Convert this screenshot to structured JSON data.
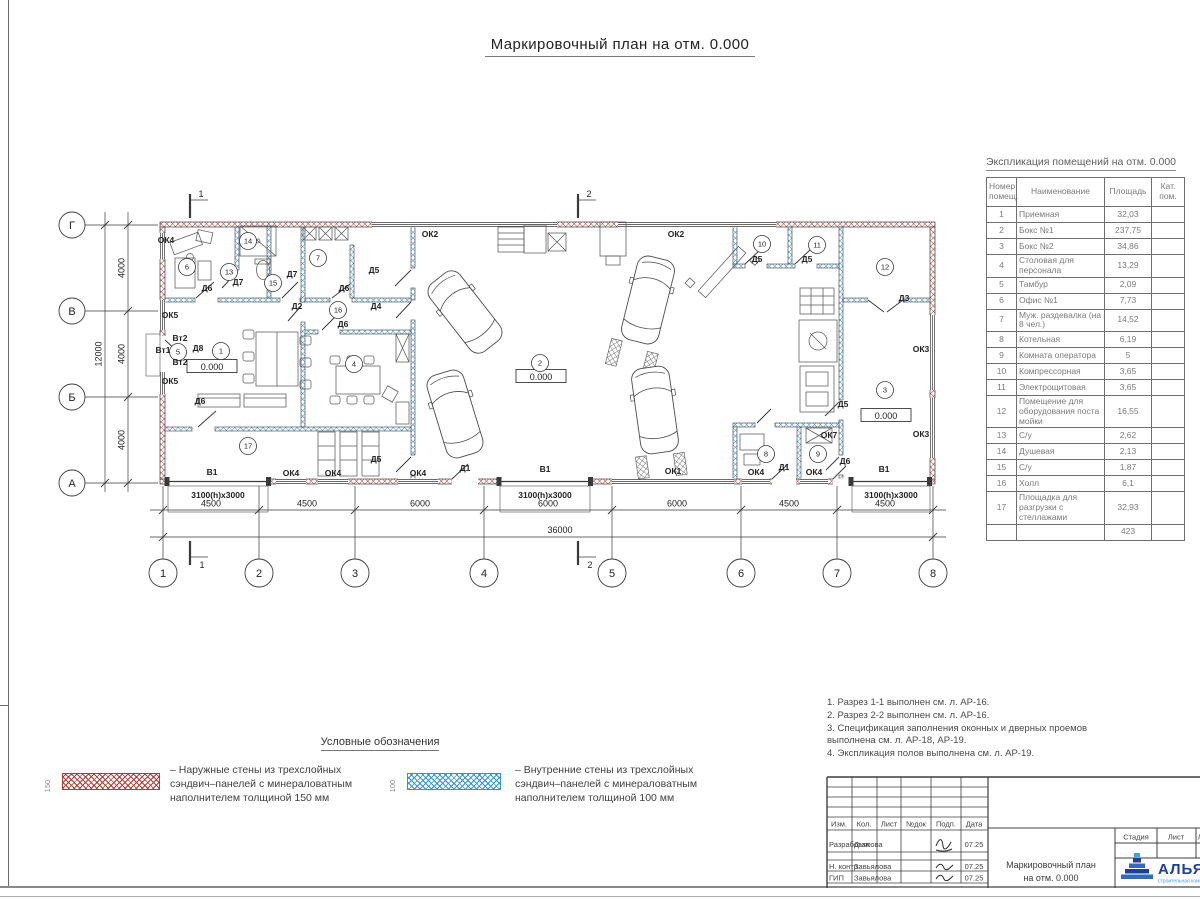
{
  "title": "Маркировочный план на отм. 0.000",
  "colors": {
    "exterior_hatch": "#b23a33",
    "interior_hatch": "#2f93cf",
    "logo_navy": "#1d3f97",
    "logo_blue": "#44a1d9"
  },
  "spec_table": {
    "title": "Экспликация помещений на отм. 0.000",
    "headers": {
      "num": "Номер помещ.",
      "name": "Наименование",
      "area": "Площадь",
      "cat": "Кат. пом."
    },
    "rows": [
      {
        "n": "1",
        "name": "Приемная",
        "area": "32,03"
      },
      {
        "n": "2",
        "name": "Бокс №1",
        "area": "237,75"
      },
      {
        "n": "3",
        "name": "Бокс №2",
        "area": "34,86"
      },
      {
        "n": "4",
        "name": "Столовая для персонала",
        "area": "13,29"
      },
      {
        "n": "5",
        "name": "Тамбур",
        "area": "2,09"
      },
      {
        "n": "6",
        "name": "Офис №1",
        "area": "7,73"
      },
      {
        "n": "7",
        "name": "Муж. раздевалка (на 8 чел.)",
        "area": "14,52"
      },
      {
        "n": "8",
        "name": "Котельная",
        "area": "6,19"
      },
      {
        "n": "9",
        "name": "Комната оператора",
        "area": "5"
      },
      {
        "n": "10",
        "name": "Компрессорная",
        "area": "3,65"
      },
      {
        "n": "11",
        "name": "Электрощитовая",
        "area": "3,65"
      },
      {
        "n": "12",
        "name": "Помещение для оборудования поста мойки",
        "area": "16,55"
      },
      {
        "n": "13",
        "name": "С/у",
        "area": "2,62"
      },
      {
        "n": "14",
        "name": "Душевая",
        "area": "2,13"
      },
      {
        "n": "15",
        "name": "С/у",
        "area": "1,87"
      },
      {
        "n": "16",
        "name": "Холл",
        "area": "6,1"
      },
      {
        "n": "17",
        "name": "Площадка для разгрузки с стеллажами",
        "area": "32,93"
      }
    ],
    "total": "423"
  },
  "notes": [
    "1. Разрез 1-1 выполнен см. л. АР-16.",
    "2. Разрез 2-2 выполнен см. л. АР-16.",
    "3. Спецификация заполнения оконных и дверных проемов выполнена см. л. АР-18, АР-19.",
    "4. Экспликация полов выполнена см. л. АР-19."
  ],
  "legend": {
    "title": "Условные обозначения",
    "items": [
      {
        "dim": "150",
        "color": "#b23a33",
        "text": "– Наружные стены из трехслойных сэндвич–панелей с минераловатным наполнителем толщиной 150 мм"
      },
      {
        "dim": "100",
        "color": "#2f93cf",
        "text": "– Внутренние стены из трехслойных сэндвич–панелей с минераловатным наполнителем толщиной 100 мм"
      }
    ]
  },
  "title_block": {
    "cols": [
      "Изм.",
      "Кол.",
      "Лист",
      "№док",
      "Подп.",
      "Дата"
    ],
    "rows": [
      {
        "role": "Разработал",
        "name": "Дьякова",
        "date": "07.25"
      },
      {
        "role": "Н. контр.",
        "name": "Завьялова",
        "date": "07.25"
      },
      {
        "role": "ГИП",
        "name": "Завьялова",
        "date": "07.25"
      }
    ],
    "doc_title_line1": "Маркировочный план",
    "doc_title_line2": "на отм. 0.000",
    "stage_cols": [
      "Стадия",
      "Лист",
      "Лис"
    ],
    "logo_text": "АЛЬЯН",
    "logo_sub": "строительная комп"
  },
  "plan": {
    "elev_value": "0.000",
    "axes_v": [
      {
        "n": "1",
        "x": 163
      },
      {
        "n": "2",
        "x": 259
      },
      {
        "n": "3",
        "x": 355
      },
      {
        "n": "4",
        "x": 484
      },
      {
        "n": "5",
        "x": 612
      },
      {
        "n": "6",
        "x": 741
      },
      {
        "n": "7",
        "x": 837
      },
      {
        "n": "8",
        "x": 933
      }
    ],
    "axes_h": [
      {
        "n": "Г",
        "y": 225
      },
      {
        "n": "В",
        "y": 311
      },
      {
        "n": "Б",
        "y": 397
      },
      {
        "n": "А",
        "y": 483
      }
    ],
    "dims_bottom": [
      {
        "t": "4500",
        "x": 211
      },
      {
        "t": "4500",
        "x": 307
      },
      {
        "t": "6000",
        "x": 420
      },
      {
        "t": "6000",
        "x": 548
      },
      {
        "t": "6000",
        "x": 677
      },
      {
        "t": "4500",
        "x": 789
      },
      {
        "t": "4500",
        "x": 885
      }
    ],
    "dim_total": {
      "t": "36000",
      "x": 560
    },
    "dims_left": [
      {
        "t": "4000",
        "y": 268
      },
      {
        "t": "4000",
        "y": 354
      },
      {
        "t": "4000",
        "y": 440
      }
    ],
    "dim_left_total": {
      "t": "12000",
      "y": 354
    },
    "sections": [
      {
        "t": "1",
        "x": 190
      },
      {
        "t": "2",
        "x": 578
      }
    ],
    "elev": [
      {
        "x": 212,
        "y": 367
      },
      {
        "x": 541,
        "y": 377
      },
      {
        "x": 886,
        "y": 416
      }
    ],
    "rooms": [
      {
        "n": "1",
        "x": 221,
        "y": 351
      },
      {
        "n": "2",
        "x": 540,
        "y": 363
      },
      {
        "n": "3",
        "x": 885,
        "y": 390
      },
      {
        "n": "4",
        "x": 354,
        "y": 364
      },
      {
        "n": "5",
        "x": 178,
        "y": 352
      },
      {
        "n": "6",
        "x": 187,
        "y": 267
      },
      {
        "n": "7",
        "x": 318,
        "y": 258
      },
      {
        "n": "8",
        "x": 766,
        "y": 454
      },
      {
        "n": "9",
        "x": 818,
        "y": 454
      },
      {
        "n": "10",
        "x": 762,
        "y": 244
      },
      {
        "n": "11",
        "x": 817,
        "y": 245
      },
      {
        "n": "12",
        "x": 885,
        "y": 267
      },
      {
        "n": "13",
        "x": 229,
        "y": 272
      },
      {
        "n": "14",
        "x": 248,
        "y": 241
      },
      {
        "n": "15",
        "x": 273,
        "y": 283
      },
      {
        "n": "16",
        "x": 338,
        "y": 310
      },
      {
        "n": "17",
        "x": 248,
        "y": 446
      }
    ],
    "labels": [
      {
        "t": "ОК4",
        "x": 166,
        "y": 243
      },
      {
        "t": "ОК5",
        "x": 170,
        "y": 318
      },
      {
        "t": "Вт2",
        "x": 180,
        "y": 341
      },
      {
        "t": "Вт1",
        "x": 163,
        "y": 353
      },
      {
        "t": "Вт2",
        "x": 180,
        "y": 365
      },
      {
        "t": "Д8",
        "x": 198,
        "y": 351
      },
      {
        "t": "ОК5",
        "x": 170,
        "y": 384
      },
      {
        "t": "Д6",
        "x": 207,
        "y": 291
      },
      {
        "t": "Д7",
        "x": 238,
        "y": 285
      },
      {
        "t": "Д7",
        "x": 292,
        "y": 277
      },
      {
        "t": "Д5",
        "x": 374,
        "y": 273
      },
      {
        "t": "Д6",
        "x": 344,
        "y": 291
      },
      {
        "t": "Д2",
        "x": 297,
        "y": 309
      },
      {
        "t": "Д4",
        "x": 376,
        "y": 309
      },
      {
        "t": "Д6",
        "x": 343,
        "y": 327
      },
      {
        "t": "Д6",
        "x": 200,
        "y": 404
      },
      {
        "t": "Д5",
        "x": 376,
        "y": 462
      },
      {
        "t": "ОК2",
        "x": 430,
        "y": 237
      },
      {
        "t": "ОК2",
        "x": 676,
        "y": 237
      },
      {
        "t": "Д5",
        "x": 757,
        "y": 262
      },
      {
        "t": "Д5",
        "x": 807,
        "y": 262
      },
      {
        "t": "Д3",
        "x": 904,
        "y": 301
      },
      {
        "t": "ОК3",
        "x": 921,
        "y": 352
      },
      {
        "t": "ОК3",
        "x": 921,
        "y": 437
      },
      {
        "t": "Д5",
        "x": 843,
        "y": 407
      },
      {
        "t": "ОК7",
        "x": 829,
        "y": 438
      },
      {
        "t": "Д6",
        "x": 845,
        "y": 464
      },
      {
        "t": "В1",
        "x": 212,
        "y": 475
      },
      {
        "t": "ОК4",
        "x": 291,
        "y": 476
      },
      {
        "t": "ОК4",
        "x": 333,
        "y": 476
      },
      {
        "t": "ОК4",
        "x": 418,
        "y": 476
      },
      {
        "t": "Д1",
        "x": 465,
        "y": 471
      },
      {
        "t": "В1",
        "x": 545,
        "y": 472
      },
      {
        "t": "ОК1",
        "x": 673,
        "y": 474
      },
      {
        "t": "ОК4",
        "x": 756,
        "y": 475
      },
      {
        "t": "Д1",
        "x": 784,
        "y": 470
      },
      {
        "t": "ОК4",
        "x": 814,
        "y": 475
      },
      {
        "t": "В1",
        "x": 884,
        "y": 472
      },
      {
        "t": "3100(h)x3000",
        "x": 218,
        "y": 498
      },
      {
        "t": "3100(h)x3000",
        "x": 545,
        "y": 498
      },
      {
        "t": "3100(h)x3000",
        "x": 891,
        "y": 498
      }
    ]
  }
}
